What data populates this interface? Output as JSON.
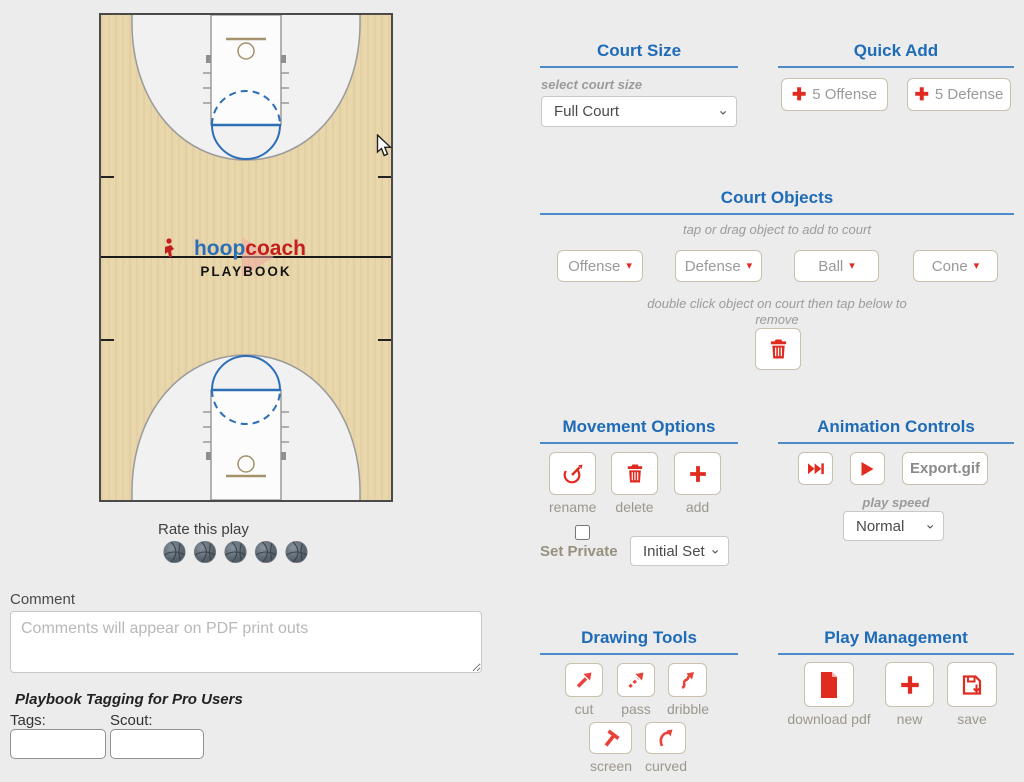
{
  "court": {
    "logo": {
      "hoop": "hoop",
      "coach": "coach",
      "playbook": "PLAYBOOK"
    },
    "rate_label": "Rate this play"
  },
  "comment": {
    "label": "Comment",
    "placeholder": "Comments will appear on PDF print outs"
  },
  "tagging": {
    "title": "Playbook Tagging for Pro Users",
    "tags_label": "Tags:",
    "scout_label": "Scout:"
  },
  "court_size": {
    "title": "Court Size",
    "helper": "select court size",
    "value": "Full Court"
  },
  "quick_add": {
    "title": "Quick Add",
    "offense": "5 Offense",
    "defense": "5 Defense"
  },
  "court_objects": {
    "title": "Court Objects",
    "helper": "tap or drag object to add to court",
    "offense": "Offense",
    "defense": "Defense",
    "ball": "Ball",
    "cone": "Cone",
    "remove_hint": "double click object on court then tap below to remove"
  },
  "movement": {
    "title": "Movement Options",
    "rename": "rename",
    "delete": "delete",
    "add": "add",
    "set_private": "Set Private",
    "set_value": "Initial Set"
  },
  "animation": {
    "title": "Animation Controls",
    "export": "Export.gif",
    "speed_label": "play speed",
    "speed_value": "Normal"
  },
  "drawing": {
    "title": "Drawing Tools",
    "cut": "cut",
    "pass": "pass",
    "dribble": "dribble",
    "screen": "screen",
    "curved": "curved"
  },
  "play_mgmt": {
    "title": "Play Management",
    "download": "download pdf",
    "new": "new",
    "save": "save"
  },
  "colors": {
    "accent_blue": "#1e6bb8",
    "underline_blue": "#4d8bc8",
    "red": "#e02b20",
    "court_line_blue": "#2d6fb7",
    "wood": "#e9d7ac"
  }
}
